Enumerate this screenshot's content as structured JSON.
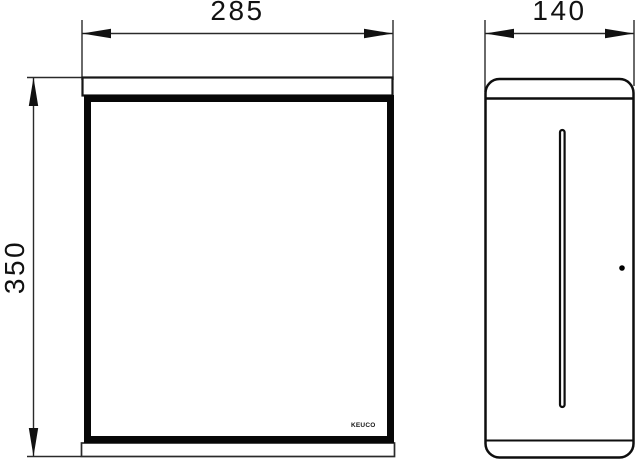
{
  "page": {
    "background_color": "#ffffff",
    "line_color": "#1a1a1a"
  },
  "dimensions": {
    "width": {
      "value": "285"
    },
    "depth": {
      "value": "140"
    },
    "height": {
      "value": "350"
    }
  },
  "brand": {
    "logo_text": "KEUCO"
  }
}
